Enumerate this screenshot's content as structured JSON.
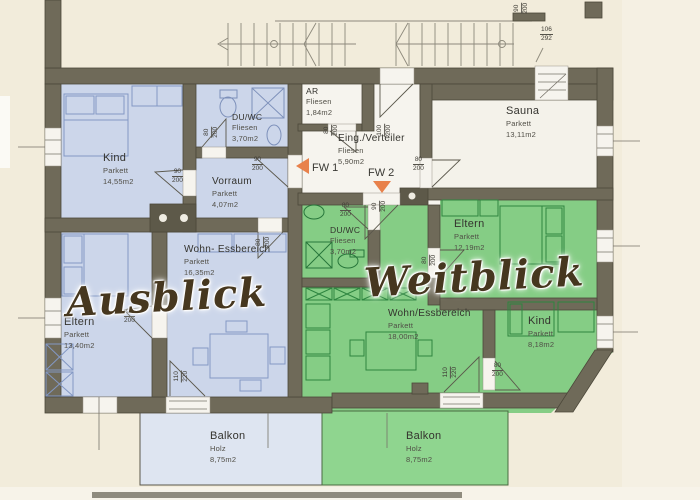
{
  "title": "Grundriss Ausblick / Weitblick",
  "colors": {
    "paper": "#f2ecdb",
    "wall": "#6f6a59",
    "blue_room": "#ccd6ea",
    "blue_balcony": "#dee5f1",
    "green_room": "#85cd85",
    "green_balcony": "#8fd58f",
    "white_room": "#f5f3ec",
    "arrow_orange": "#e8814b",
    "script_brown": "#46371f"
  },
  "apartments": {
    "left": {
      "script_label": "Ausblick",
      "tint": "#ccd6ea"
    },
    "right": {
      "script_label": "Weitblick",
      "tint": "#85cd85"
    }
  },
  "fw": {
    "fw1": "FW 1",
    "fw2": "FW 2"
  },
  "rooms": [
    {
      "id": "kind-left",
      "apartment": "left",
      "name": "Kind",
      "floor": "Parkett",
      "area": "14,55m2",
      "x": 103,
      "y": 152,
      "size": ""
    },
    {
      "id": "du-wc-left",
      "apartment": "left",
      "name": "DU/WC",
      "floor": "Fliesen",
      "area": "3,70m2",
      "x": 232,
      "y": 112,
      "size": "s"
    },
    {
      "id": "vorraum",
      "apartment": "left",
      "name": "Vorraum",
      "floor": "Parkett",
      "area": "4,07m2",
      "x": 212,
      "y": 176,
      "size": "m"
    },
    {
      "id": "wohn-essbereich-left",
      "apartment": "left",
      "name": "Wohn- Essbereich",
      "floor": "Parkett",
      "area": "16,35m2",
      "x": 184,
      "y": 244,
      "size": "m"
    },
    {
      "id": "eltern-left",
      "apartment": "left",
      "name": "Eltern",
      "floor": "Parkett",
      "area": "13,40m2",
      "x": 64,
      "y": 316,
      "size": ""
    },
    {
      "id": "balkon-left",
      "apartment": "left",
      "name": "Balkon",
      "floor": "Holz",
      "area": "8,75m2",
      "x": 210,
      "y": 430,
      "size": ""
    },
    {
      "id": "ar",
      "apartment": "common",
      "name": "AR",
      "floor": "Fliesen",
      "area": "1,84m2",
      "x": 306,
      "y": 86,
      "size": "s"
    },
    {
      "id": "eing-verteiler",
      "apartment": "common",
      "name": "Eing./Verteiler",
      "floor": "Fliesen",
      "area": "5,90m2",
      "x": 338,
      "y": 133,
      "size": "m"
    },
    {
      "id": "sauna",
      "apartment": "common",
      "name": "Sauna",
      "floor": "Parkett",
      "area": "13,11m2",
      "x": 506,
      "y": 105,
      "size": ""
    },
    {
      "id": "eltern-right",
      "apartment": "right",
      "name": "Eltern",
      "floor": "Parkett",
      "area": "12,19m2",
      "x": 454,
      "y": 218,
      "size": ""
    },
    {
      "id": "du-wc-right",
      "apartment": "right",
      "name": "DU/WC",
      "floor": "Fliesen",
      "area": "3,70m2",
      "x": 330,
      "y": 225,
      "size": "s"
    },
    {
      "id": "wohn-essbereich-right",
      "apartment": "right",
      "name": "Wohn/Essbereich",
      "floor": "Parkett",
      "area": "18,00m2",
      "x": 388,
      "y": 308,
      "size": "m"
    },
    {
      "id": "kind-right",
      "apartment": "right",
      "name": "Kind",
      "floor": "Parkett",
      "area": "8,18m2",
      "x": 528,
      "y": 315,
      "size": ""
    },
    {
      "id": "balkon-right",
      "apartment": "right",
      "name": "Balkon",
      "floor": "Holz",
      "area": "8,75m2",
      "x": 406,
      "y": 430,
      "size": ""
    }
  ],
  "dim_labels": [
    {
      "num": "90",
      "den": "200",
      "x": 172,
      "y": 168,
      "rot": 0
    },
    {
      "num": "80",
      "den": "200",
      "x": 206,
      "y": 124,
      "rot": 90
    },
    {
      "num": "90",
      "den": "200",
      "x": 252,
      "y": 156,
      "rot": 0
    },
    {
      "num": "80",
      "den": "200",
      "x": 258,
      "y": 234,
      "rot": 90
    },
    {
      "num": "90",
      "den": "200",
      "x": 124,
      "y": 308,
      "rot": 0
    },
    {
      "num": "110",
      "den": "220",
      "x": 175,
      "y": 368,
      "rot": 90
    },
    {
      "num": "80",
      "den": "200",
      "x": 326,
      "y": 122,
      "rot": 90
    },
    {
      "num": "100",
      "den": "200",
      "x": 378,
      "y": 122,
      "rot": 90
    },
    {
      "num": "80",
      "den": "200",
      "x": 413,
      "y": 156,
      "rot": 0
    },
    {
      "num": "90",
      "den": "200",
      "x": 374,
      "y": 198,
      "rot": 90
    },
    {
      "num": "80",
      "den": "200",
      "x": 340,
      "y": 202,
      "rot": 0
    },
    {
      "num": "80",
      "den": "200",
      "x": 424,
      "y": 252,
      "rot": 90
    },
    {
      "num": "110",
      "den": "220",
      "x": 444,
      "y": 364,
      "rot": 90
    },
    {
      "num": "80",
      "den": "200",
      "x": 492,
      "y": 362,
      "rot": 0
    },
    {
      "num": "106",
      "den": "292",
      "x": 540,
      "y": 26,
      "rot": 0
    },
    {
      "num": "90",
      "den": "200",
      "x": 516,
      "y": 0,
      "rot": 90
    }
  ]
}
